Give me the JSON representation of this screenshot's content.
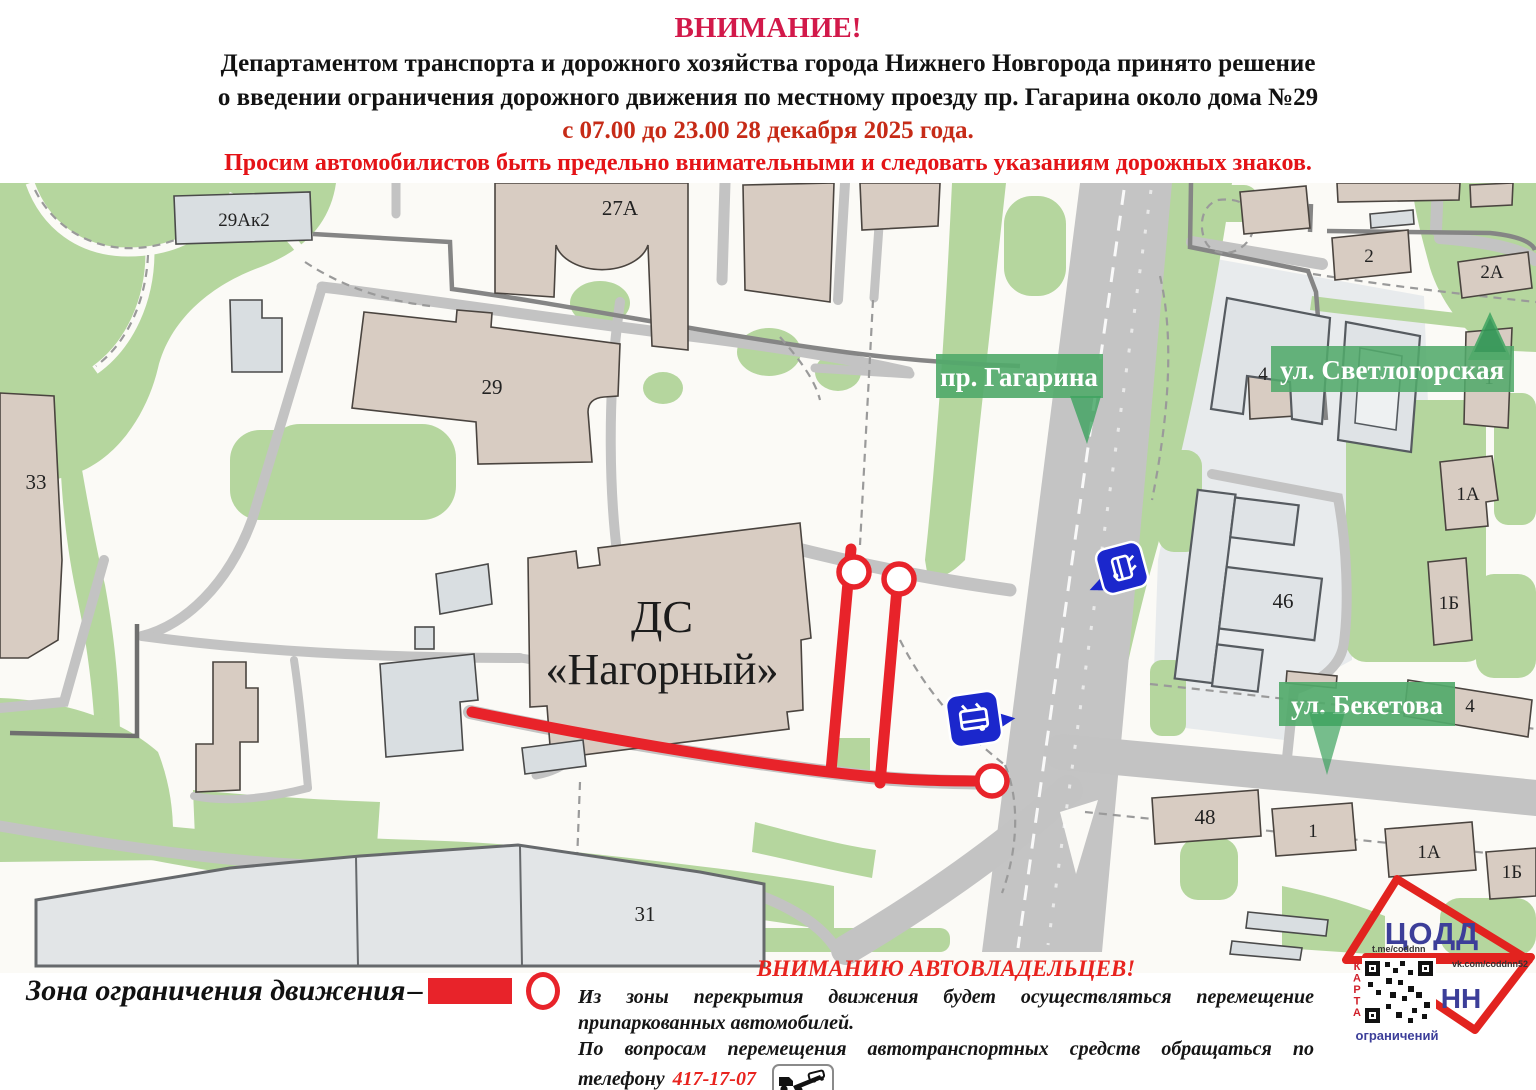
{
  "header": {
    "line1": "ВНИМАНИЕ!",
    "line2": "Департаментом транспорта и дорожного хозяйства города Нижнего Новгорода принято решение",
    "line3": "о введении ограничения дорожного движения по местному проезду пр. Гагарина около дома №29",
    "line4": "с 07.00 до 23.00 28 декабря 2025 года.",
    "line5": "Просим автомобилистов быть предельно внимательными и следовать указаниям дорожных знаков."
  },
  "map": {
    "street_banners": [
      {
        "text": "пр. Гагарина"
      },
      {
        "text": "ул. Светлогорская"
      },
      {
        "text": "ул. Бекетова"
      }
    ],
    "dc_building": {
      "line1": "ДС",
      "line2": "«Нагорный»"
    },
    "building_labels": [
      {
        "text": "29Ак2"
      },
      {
        "text": "27А"
      },
      {
        "text": "29"
      },
      {
        "text": "33"
      },
      {
        "text": "2"
      },
      {
        "text": "2А"
      },
      {
        "text": "4"
      },
      {
        "text": "1"
      },
      {
        "text": "1А"
      },
      {
        "text": "1Б"
      },
      {
        "text": "46"
      },
      {
        "text": "4"
      },
      {
        "text": "48"
      },
      {
        "text": "1"
      },
      {
        "text": "1А"
      },
      {
        "text": "1Б"
      },
      {
        "text": "31"
      }
    ]
  },
  "legend": {
    "label": "Зона ограничения движения",
    "dash": "–"
  },
  "notice": {
    "title": "ВНИМАНИЮ АВТОВЛАДЕЛЬЦЕВ!",
    "line1": "Из зоны перекрытия движения будет осуществляться перемещение",
    "line2": "припаркованных автомобилей.",
    "line3": "По вопросам перемещения автотранспортных средств обращаться по",
    "line4_prefix": "телефону",
    "phone": "417-17-07"
  },
  "logo": {
    "org": "ЦОДД",
    "city": "НН",
    "telegram": "t.me/coddnn",
    "vk": "vk.com/coddnn52",
    "qr_vertical": "КАРТА",
    "qr_caption": "ограничений"
  },
  "colors": {
    "alert_red": "#e8232a",
    "title_crimson": "#d2194a",
    "banner_green": "#52aa6b"
  }
}
